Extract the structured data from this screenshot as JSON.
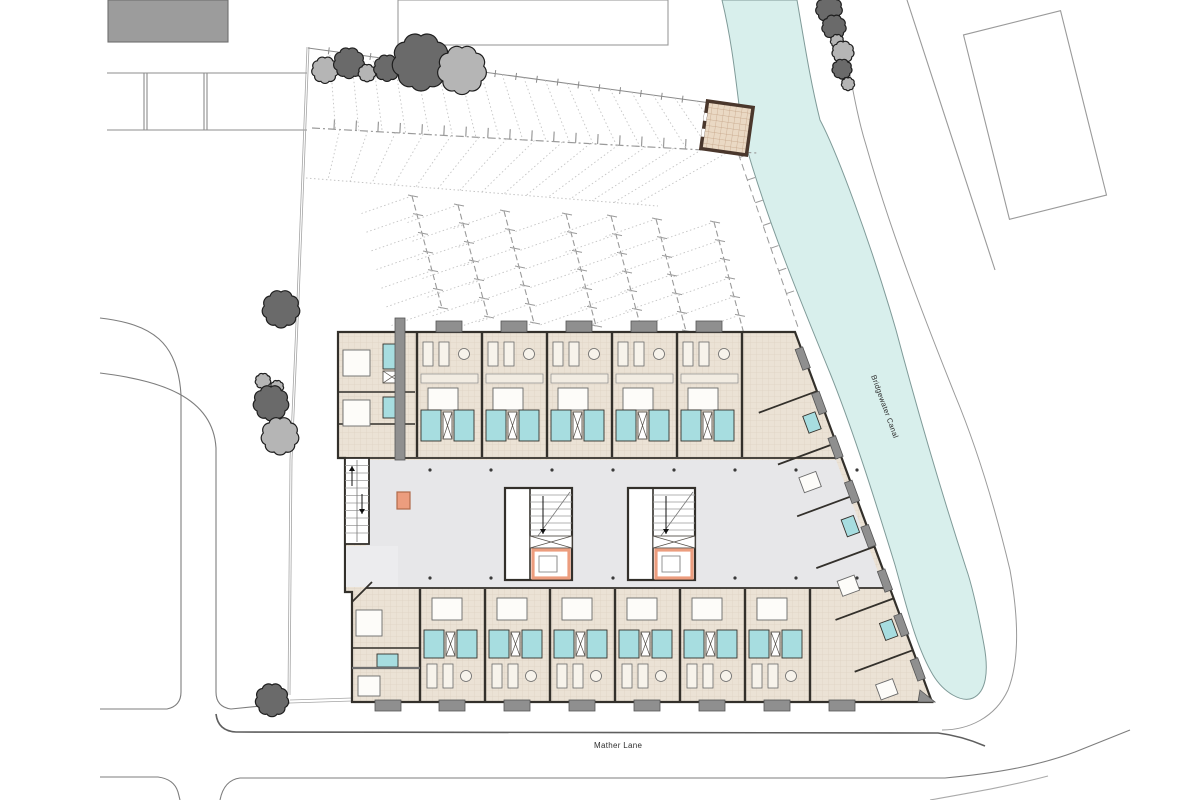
{
  "labels": {
    "canal": "Bridgewater Canal",
    "road": "Mather Lane"
  },
  "colors": {
    "canal": "#d8efec",
    "canal_stroke": "#7f9a98",
    "floor": "#ebe2d5",
    "floor_grid": "#d9cdbc",
    "bathroom": "#a7dde0",
    "corridor": "#e7e7e9",
    "wall": "#33302b",
    "balcony": "#8f8f8f",
    "lift": "#ec9d7e",
    "tree_dark": "#6a6a6a",
    "tree_light": "#b5b5b5",
    "tree_stroke": "#1e1e1e",
    "massing": "#9c9c9c",
    "road": "#7d7d7d",
    "faint": "#c7c7c7",
    "parking": "#a0a0a0",
    "shed_wall": "#4a372c",
    "label": "#2e2e2e"
  },
  "trees": [
    [
      325,
      70,
      12,
      "l"
    ],
    [
      349,
      63,
      14,
      "d"
    ],
    [
      367,
      73,
      8,
      "l"
    ],
    [
      387,
      68,
      12,
      "d"
    ],
    [
      421,
      62,
      26,
      "d"
    ],
    [
      462,
      70,
      22,
      "l"
    ],
    [
      829,
      9,
      12,
      "d"
    ],
    [
      834,
      27,
      11,
      "d"
    ],
    [
      837,
      41,
      6,
      "l"
    ],
    [
      843,
      52,
      10,
      "l"
    ],
    [
      842,
      69,
      9,
      "d"
    ],
    [
      848,
      84,
      6,
      "l"
    ],
    [
      281,
      309,
      17,
      "d"
    ],
    [
      263,
      381,
      7,
      "l"
    ],
    [
      277,
      387,
      6,
      "l"
    ],
    [
      271,
      403,
      16,
      "d"
    ],
    [
      280,
      436,
      17,
      "l"
    ],
    [
      272,
      700,
      15,
      "d"
    ]
  ],
  "parking": {
    "fence": [
      308,
      48,
      718,
      104
    ],
    "aisle": [
      312,
      128,
      757,
      153
    ],
    "stall_edge": [
      306,
      178,
      658,
      206
    ],
    "tick_spacing": 21,
    "fans": [
      [
        412,
        196
      ],
      [
        458,
        205
      ],
      [
        504,
        211
      ],
      [
        566,
        214
      ],
      [
        611,
        216
      ],
      [
        656,
        219
      ],
      [
        714,
        222
      ]
    ],
    "spine_vec": [
      30,
      112
    ],
    "stall_vec": [
      -52,
      18
    ],
    "stalls_per_fan": 6,
    "canal_edge_dash": [
      724,
      112,
      799,
      330
    ]
  },
  "building": {
    "top_wall_y": [
      332,
      458
    ],
    "bottom_wall_y": [
      588,
      702
    ],
    "top_party_x": [
      417,
      482,
      547,
      612,
      677,
      742
    ],
    "bottom_party_x": [
      420,
      485,
      550,
      615,
      680,
      745,
      810
    ],
    "top_stub_cx": [
      449,
      514,
      579,
      644,
      709
    ],
    "bottom_stub_cx": [
      388,
      452,
      517,
      582,
      647,
      712,
      777,
      842
    ],
    "cores_x": [
      505,
      628
    ],
    "core_y": 488,
    "balcony_t": [
      0.07,
      0.19,
      0.31,
      0.43,
      0.55,
      0.67,
      0.79,
      0.91
    ],
    "angled_wall_t": [
      0.16,
      0.3,
      0.44,
      0.58,
      0.72,
      0.86
    ],
    "angled_pod_t": [
      0.23,
      0.51,
      0.79
    ],
    "angled_bed_t": [
      0.37,
      0.65,
      0.93
    ],
    "canal_wall": [
      795,
      332,
      932,
      702
    ]
  }
}
